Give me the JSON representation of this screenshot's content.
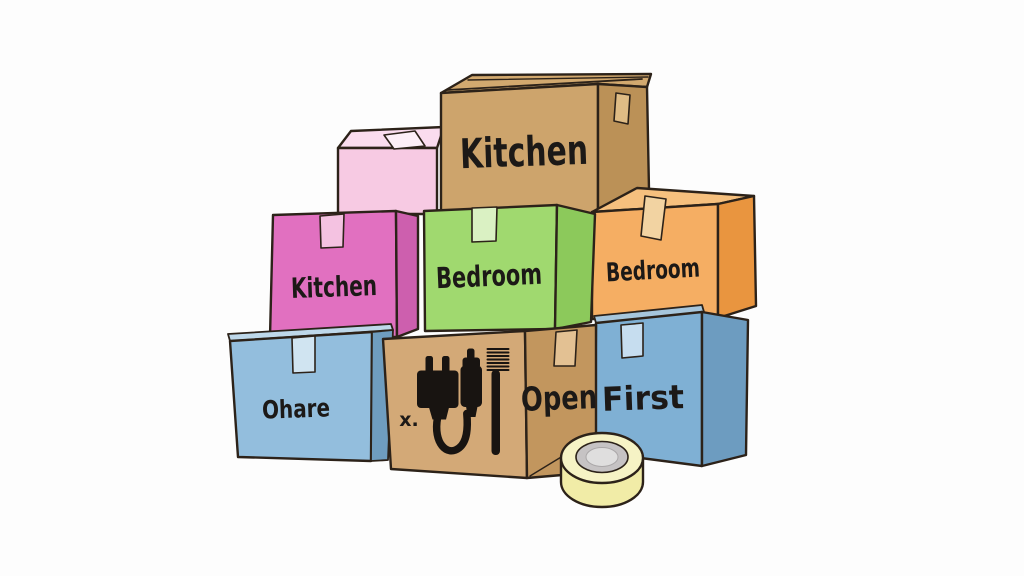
{
  "scene": {
    "background": "#fdfdfd",
    "outline_color": "#2c2219",
    "text_color": "#1c1917",
    "icon_color": "#181411"
  },
  "boxes": {
    "pink_small": {
      "label": "",
      "front": "#f7cae3",
      "top": "#fadcee",
      "tape": "#fdeff7"
    },
    "brown_kitchen": {
      "label": "Kitchen",
      "front": "#cda46c",
      "side": "#bb9157",
      "top": "#d2a96f",
      "tape": "#dfbc85"
    },
    "magenta_kitchen": {
      "label": "Kitchen",
      "front": "#e170c0",
      "side": "#cd5fae",
      "tape": "#f4c2e1"
    },
    "green_bedroom": {
      "label": "Bedroom",
      "front": "#a0d96f",
      "side": "#8cc95b",
      "tape": "#daf1c3"
    },
    "orange_bedroom": {
      "label": "Bedroom",
      "front": "#f5ae63",
      "side": "#e9953f",
      "top": "#f6c07e",
      "tape": "#f2d3a2"
    },
    "blue_ohare": {
      "label": "Ohare",
      "front": "#93bedd",
      "side": "#6f9dbf",
      "top": "#bed8ea",
      "tape": "#d0e4f1"
    },
    "essentials": {
      "side_label": "Open",
      "x_mark": "x.",
      "front": "#d3a977",
      "side": "#c2965e",
      "tape": "#e3c193",
      "icons": [
        "power-plug-icon",
        "charger-icon",
        "toothbrush-icon"
      ]
    },
    "blue_first": {
      "label": "First",
      "front": "#7fb0d4",
      "side": "#6d9cc0",
      "top": "#a6c6dc",
      "tape": "#c6ddef"
    }
  },
  "tape_roll": {
    "body": "#f1eca7",
    "top": "#f6f3c5",
    "ring": "#c6c3c4",
    "hole": "#dfdede"
  }
}
